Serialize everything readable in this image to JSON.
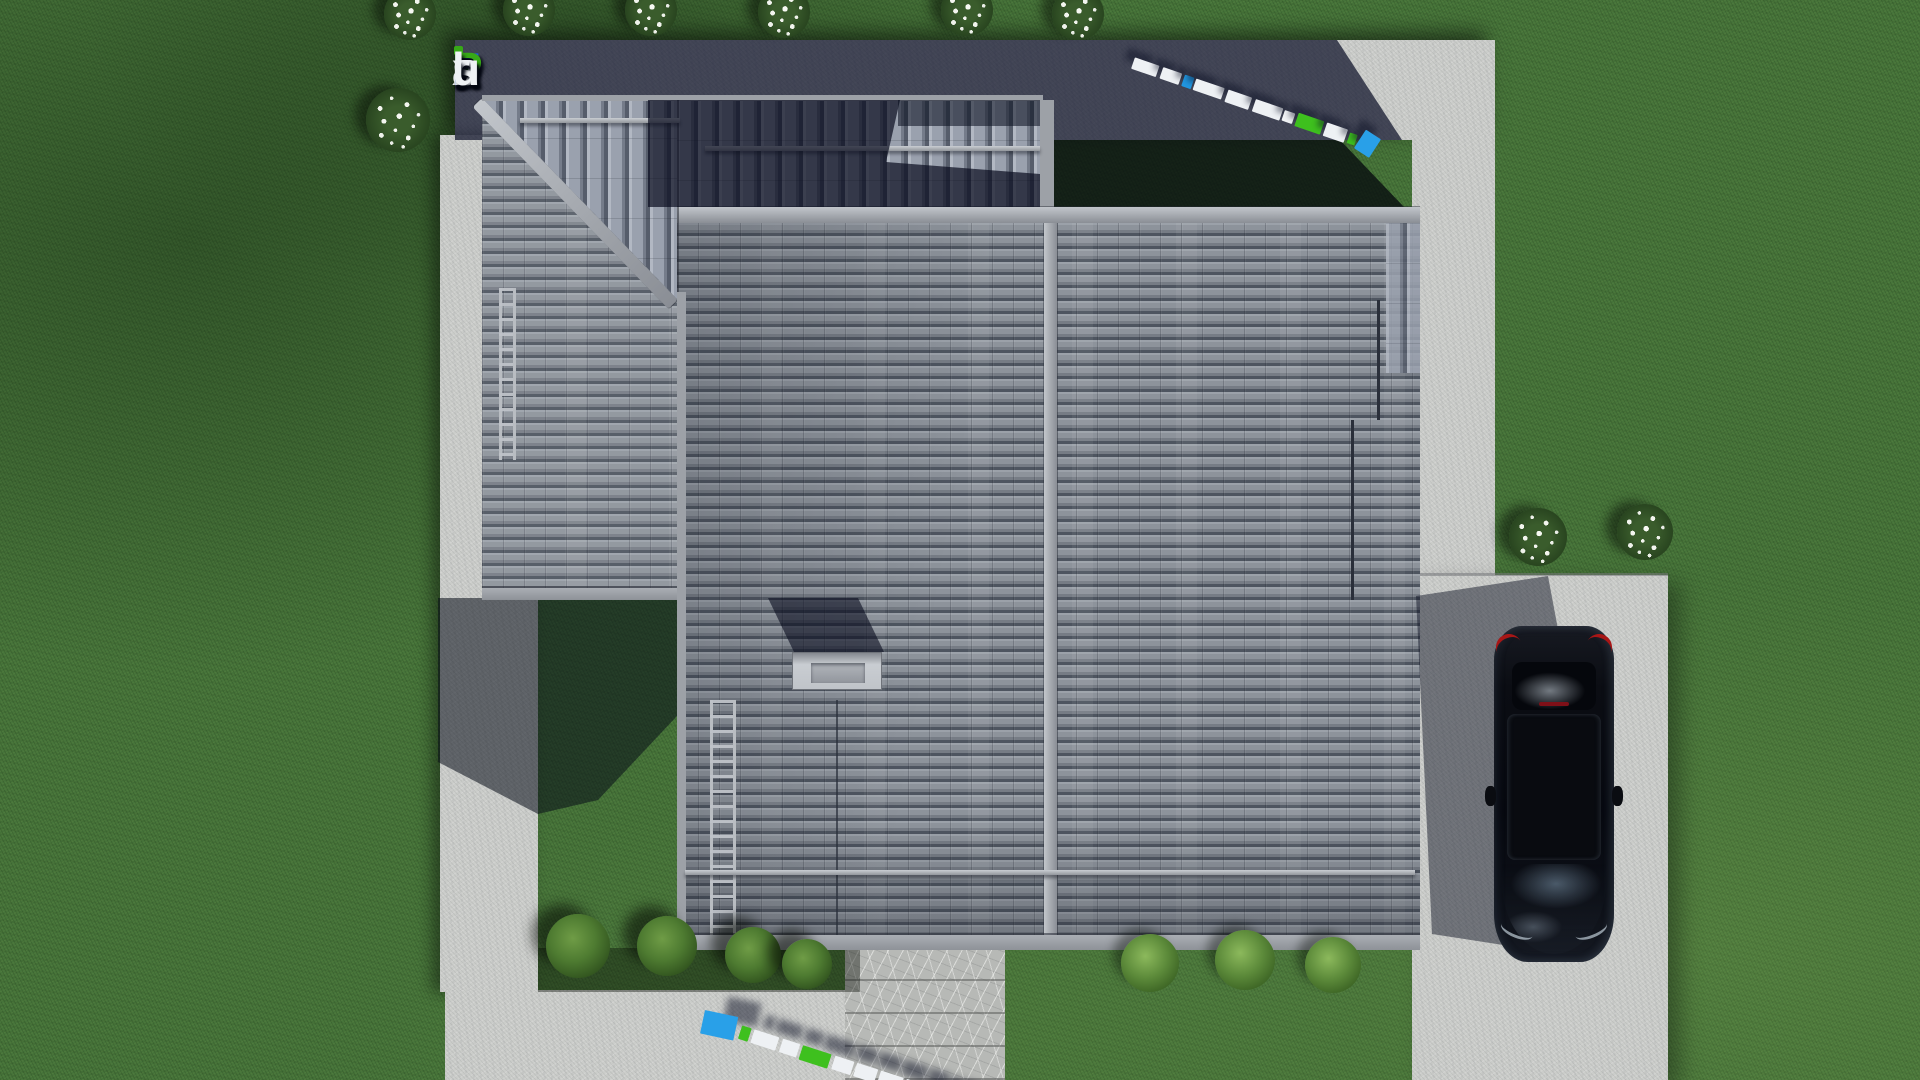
{
  "meta": {
    "site": "FixPlans.ru",
    "scene": "Top-down 3D architectural render of a hip/gable tiled roof of a single-family house with concrete walkways, driveway, parked black car, lawn, shrubs and flower bushes",
    "view": "aerial top-down"
  },
  "logo": {
    "text": "FixPlans.ru",
    "letters": [
      {
        "ch": "F",
        "color": "#1d63da"
      },
      {
        "ch": "i",
        "color": "#eef1f4",
        "dot": "#37a917"
      },
      {
        "ch": "x",
        "color": "#eef1f4"
      },
      {
        "ch": "P",
        "color": "#37a917"
      },
      {
        "ch": "l",
        "color": "#eef1f4"
      },
      {
        "ch": "a",
        "color": "#eef1f4"
      },
      {
        "ch": "n",
        "color": "#eef1f4"
      },
      {
        "ch": "s",
        "color": "#eef1f4"
      },
      {
        "ch": ".",
        "color": "#1d63da"
      },
      {
        "ch": "r",
        "color": "#eef1f4"
      },
      {
        "ch": "u",
        "color": "#eef1f4"
      }
    ]
  },
  "watermark_top": {
    "text": "FixPlans.ru",
    "angle_deg": 19,
    "blocks": [
      {
        "w": 26,
        "h": 12,
        "c": "#eef1f4"
      },
      {
        "g": 4,
        "w": 20,
        "h": 12,
        "c": "#eef1f4"
      },
      {
        "g": 3,
        "w": 10,
        "h": 12,
        "c": "#2196e0"
      },
      {
        "g": 2,
        "w": 30,
        "h": 12,
        "c": "#eef1f4"
      },
      {
        "g": 4,
        "w": 25,
        "h": 13,
        "c": "#eef1f4"
      },
      {
        "g": 4,
        "w": 29,
        "h": 13,
        "c": "#eef1f4"
      },
      {
        "g": 2,
        "w": 11,
        "h": 11,
        "c": "#f2f4f6"
      },
      {
        "g": 3,
        "w": 27,
        "h": 14,
        "c": "#3ec01e"
      },
      {
        "g": 3,
        "w": 22,
        "h": 14,
        "c": "#eef1f4"
      },
      {
        "g": 3,
        "w": 8,
        "h": 11,
        "c": "#3ec01e"
      },
      {
        "g": 3,
        "w": 18,
        "h": 22,
        "c": "#29a0e8",
        "tilt": 14
      }
    ]
  },
  "watermark_bottom": {
    "text": "FixPlans.ru",
    "angle_deg": 18,
    "blocks": [
      {
        "w": 34,
        "h": 24,
        "c": "#29a0e8",
        "tilt": -6
      },
      {
        "g": 5,
        "w": 10,
        "h": 14,
        "c": "#3ec01e"
      },
      {
        "g": 3,
        "w": 26,
        "h": 14,
        "c": "#eef1f4"
      },
      {
        "g": 4,
        "w": 18,
        "h": 14,
        "c": "#eef1f4"
      },
      {
        "g": 3,
        "w": 30,
        "h": 15,
        "c": "#3ec01e"
      },
      {
        "g": 4,
        "w": 20,
        "h": 14,
        "c": "#eef1f4"
      },
      {
        "g": 3,
        "w": 22,
        "h": 14,
        "c": "#eef1f4"
      },
      {
        "g": 3,
        "w": 24,
        "h": 15,
        "c": "#eef1f4"
      },
      {
        "g": 3,
        "w": 20,
        "h": 15,
        "c": "#eef1f4"
      },
      {
        "g": 3,
        "w": 10,
        "h": 12,
        "c": "#2196e0"
      },
      {
        "g": 3,
        "w": 20,
        "h": 15,
        "c": "#eef1f4"
      },
      {
        "g": 3,
        "w": 24,
        "h": 16,
        "c": "#eef1f4"
      }
    ]
  },
  "palette": {
    "grass": "#46743a",
    "concrete": "#cbcdca",
    "concrete_in_shadow": "#424660",
    "roof_tile": "#8f949c",
    "roof_tile_seam": "#4e5560",
    "roof_shadow": "#242836",
    "ridge_cap": "#a9adb3",
    "chimney": "#c0c4c9",
    "car_paint": "#0b0d13",
    "car_taillight": "#a81616",
    "brand_blue": "#1d63da",
    "brand_green": "#37a917",
    "watermark_blue": "#29a0e8",
    "watermark_green": "#3ec01e"
  },
  "scene": {
    "objects": [
      {
        "label": "hip and gable tiled roof with ridge caps, snow guards, roof ladders and chimney"
      },
      {
        "label": "concrete walkway band along top with FixPlans.ru logo wall shadow"
      },
      {
        "label": "left concrete walkway strip"
      },
      {
        "label": "bottom concrete walkway with stamped stone pad"
      },
      {
        "label": "right concrete driveway with parked black car"
      },
      {
        "label": "six white flower bushes along top edge, one large at left, two near driveway"
      },
      {
        "label": "four dark shrubs in left planting bed, three light shrubs in right bed"
      },
      {
        "label": "two extruded 3D FixPlans.ru watermarks lying on the walkways"
      }
    ]
  }
}
